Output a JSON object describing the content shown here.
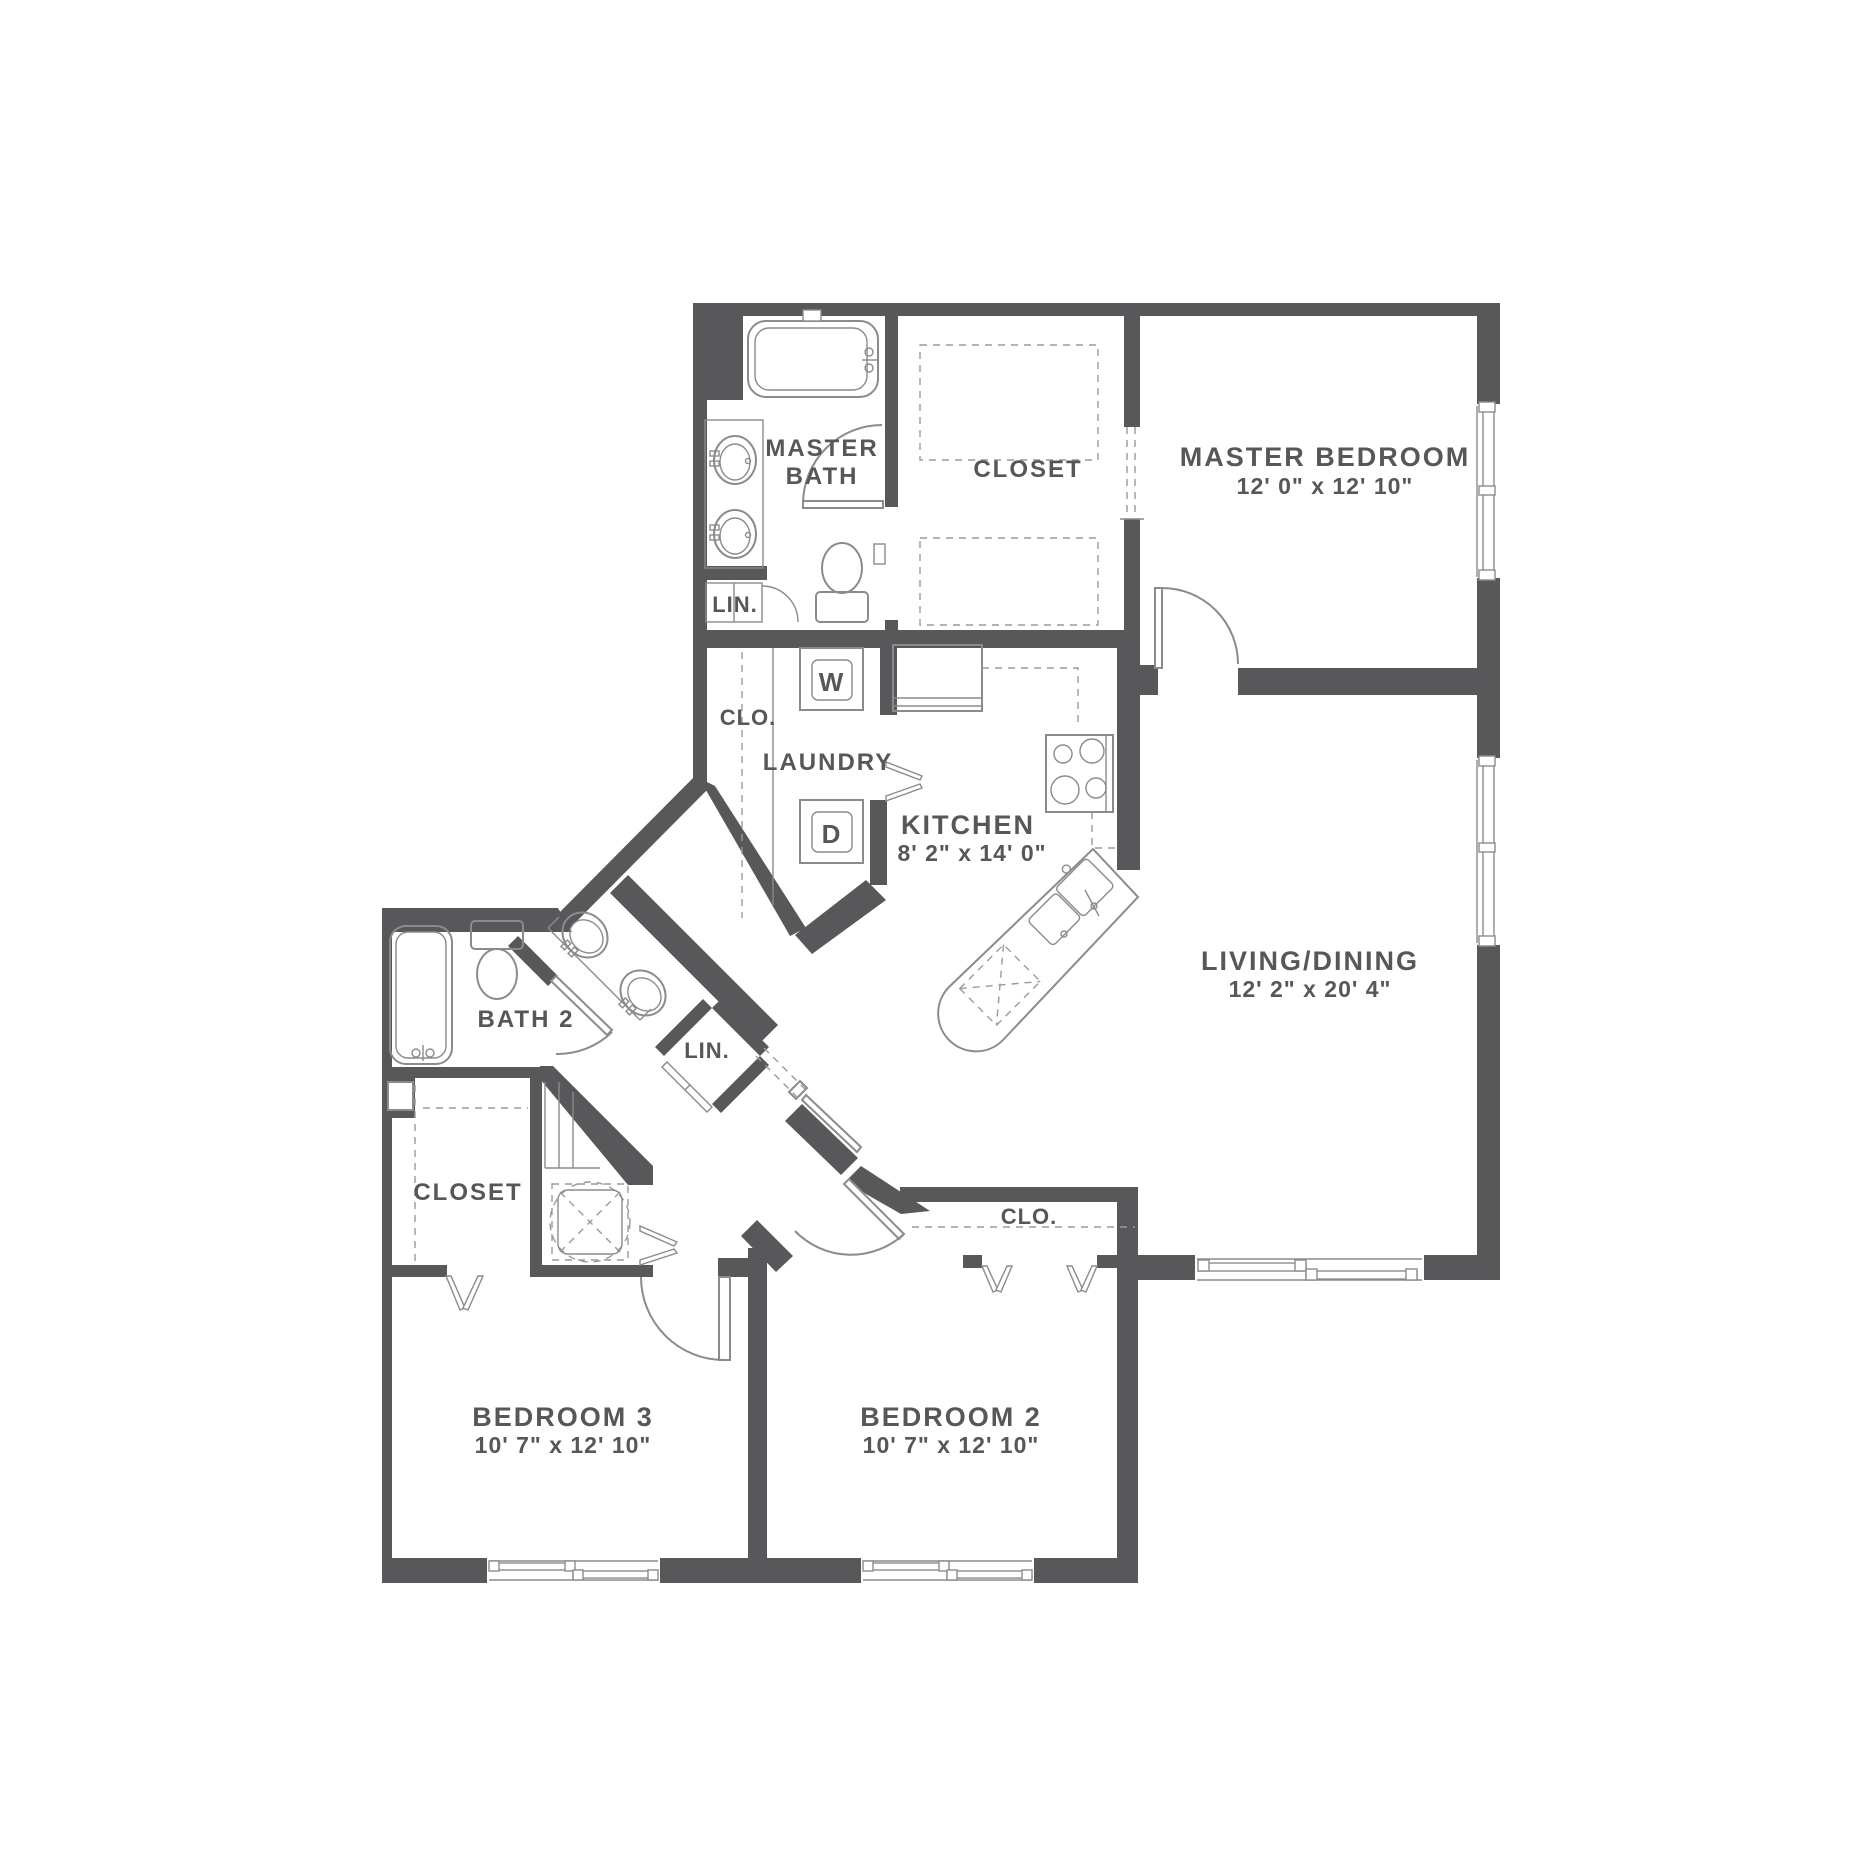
{
  "floorplan": {
    "type": "apartment-floor-plan",
    "colors": {
      "wall": "#58585a",
      "line": "#8b8b8d",
      "dash": "#9a9a9c",
      "text": "#57575a",
      "bg": "#ffffff"
    },
    "rooms": {
      "master_bath": {
        "name_line1": "MASTER",
        "name_line2": "BATH"
      },
      "master_closet": {
        "name": "CLOSET"
      },
      "master_bedroom": {
        "name": "MASTER BEDROOM",
        "dims": "12' 0\" x 12' 10\""
      },
      "linen_master": {
        "name": "LIN."
      },
      "laundry_closet": {
        "name": "CLO."
      },
      "laundry": {
        "name": "LAUNDRY",
        "washer": "W",
        "dryer": "D"
      },
      "kitchen": {
        "name": "KITCHEN",
        "dims": "8' 2\" x 14' 0\""
      },
      "living_dining": {
        "name": "LIVING/DINING",
        "dims": "12' 2\" x 20' 4\""
      },
      "bath2": {
        "name": "BATH 2"
      },
      "linen_hall": {
        "name": "LIN."
      },
      "hall_closet": {
        "name": "CLOSET"
      },
      "bedroom2_closet": {
        "name": "CLO."
      },
      "bedroom3": {
        "name": "BEDROOM 3",
        "dims": "10' 7\" x 12' 10\""
      },
      "bedroom2": {
        "name": "BEDROOM 2",
        "dims": "10' 7\" x 12' 10\""
      }
    }
  }
}
